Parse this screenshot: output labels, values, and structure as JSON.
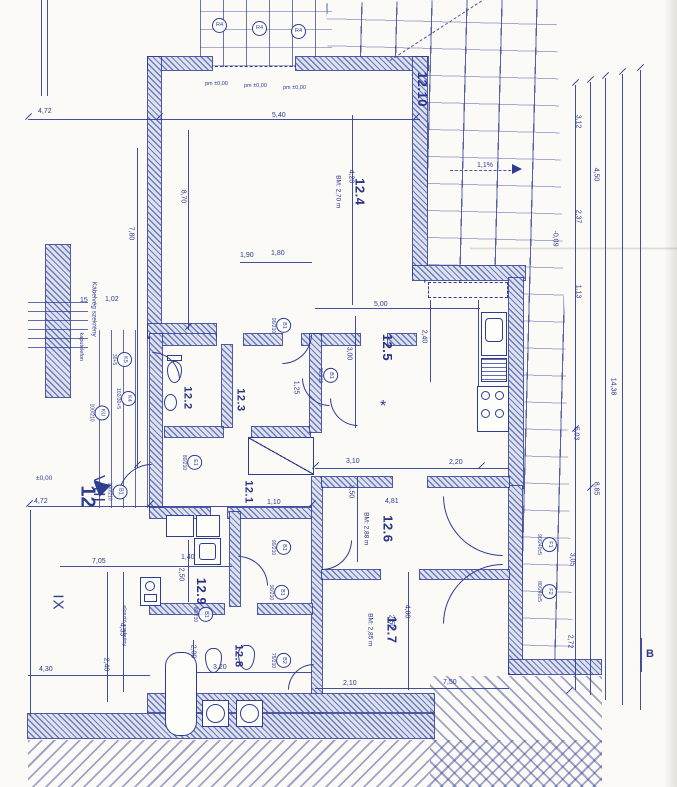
{
  "drawing": {
    "type": "architectural floor plan (scanned blueprint, apartment 12, rotated 90°)",
    "ink_color": "#2e3c92",
    "paper_color": "#fbfaf6"
  },
  "rooms": [
    {
      "label": "12.4",
      "note": "BM: 2,70 m"
    },
    {
      "label": "12.5",
      "note": ""
    },
    {
      "label": "12.10",
      "note": ""
    },
    {
      "label": "12.2",
      "note": ""
    },
    {
      "label": "12.3",
      "note": ""
    },
    {
      "label": "12.1",
      "note": ""
    },
    {
      "label": "12.6",
      "note": "BM: 2,88 m"
    },
    {
      "label": "12.7",
      "note": "BM: 2,85 m"
    },
    {
      "label": "12.8",
      "note": ""
    },
    {
      "label": "12.9",
      "note": ""
    }
  ],
  "markers": {
    "apartment": "12",
    "stair_core_left": "VIII",
    "stair_core_right": "IX",
    "level": "±0,00",
    "section": "B",
    "slope": "1,1%"
  },
  "annotations": {
    "cable_cabinet": "Kábelvég szekrény",
    "intercom": "kaputelefon",
    "dist_cabinet": "elosztó szekrény",
    "col": "R4",
    "col_level": "pm ±0,00",
    "asterisk": "*"
  },
  "dims": [
    {
      "v": "4,72"
    },
    {
      "v": "5,40"
    },
    {
      "v": "1,90"
    },
    {
      "v": "1,80"
    },
    {
      "v": "5,00"
    },
    {
      "v": "1,02"
    },
    {
      "v": "15"
    },
    {
      "v": "4,72"
    },
    {
      "v": "1,10"
    },
    {
      "v": "3,10"
    },
    {
      "v": "2,20"
    },
    {
      "v": "4,81"
    },
    {
      "v": "1,40"
    },
    {
      "v": "7,05"
    },
    {
      "v": "3,20"
    },
    {
      "v": "2,10"
    },
    {
      "v": "7,50"
    },
    {
      "v": "4,30"
    },
    {
      "v": "8,70"
    },
    {
      "v": "7,80"
    },
    {
      "v": "4,20"
    },
    {
      "v": "3,00"
    },
    {
      "v": "2,40"
    },
    {
      "v": "1,25"
    },
    {
      "v": "3,50"
    },
    {
      "v": "2,50"
    },
    {
      "v": "2,00"
    },
    {
      "v": "4,33"
    },
    {
      "v": "2,40"
    },
    {
      "v": "2,50"
    },
    {
      "v": "4,80"
    },
    {
      "v": "3,12"
    },
    {
      "v": "4,50"
    },
    {
      "v": "2,37"
    },
    {
      "v": "1,13"
    },
    {
      "v": "5,03"
    },
    {
      "v": "8,85"
    },
    {
      "v": "3,05"
    },
    {
      "v": "2,72"
    },
    {
      "v": "14,38"
    },
    {
      "v": "-0,09"
    }
  ],
  "tags": [
    {
      "code": "B1",
      "size": "90/210"
    },
    {
      "code": "B1",
      "size": "90/210"
    },
    {
      "code": "B1",
      "size": "90/210"
    },
    {
      "code": "B1",
      "size": "90/210"
    },
    {
      "code": "B1",
      "size": "80/210"
    },
    {
      "code": "B2",
      "size": "75/210"
    },
    {
      "code": "KU",
      "size": "100/210"
    },
    {
      "code": "K5",
      "size": "30+5"
    },
    {
      "code": "K4",
      "size": "102/30+5"
    },
    {
      "code": "B1",
      "size": "100/210"
    },
    {
      "code": "F1",
      "size": "90/240±5"
    },
    {
      "code": "F2",
      "size": "80/240±5"
    },
    {
      "code": "E1",
      "size": "80/210"
    }
  ]
}
